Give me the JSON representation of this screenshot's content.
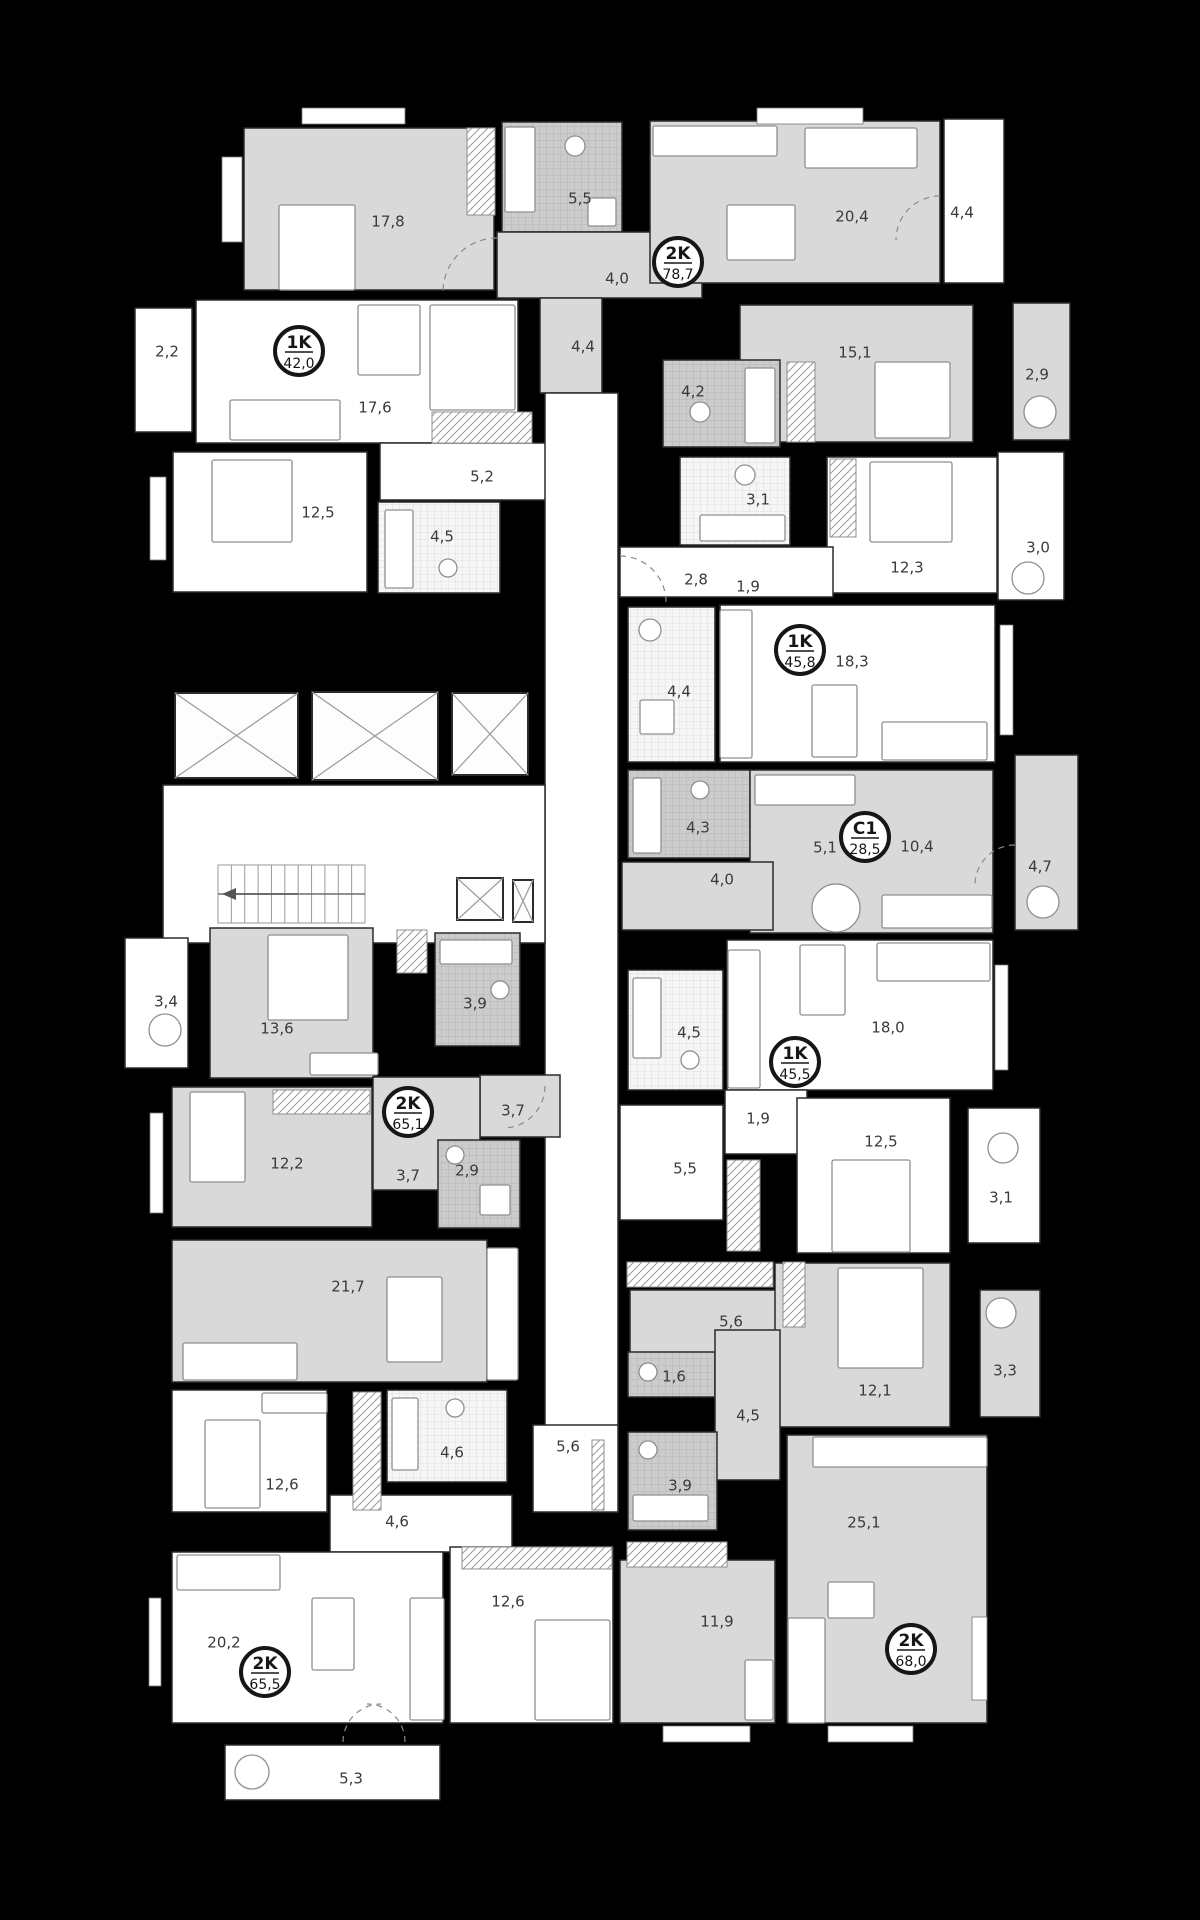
{
  "colors": {
    "background": "#000000",
    "room_gray": "#d9d9d9",
    "room_white": "#ffffff",
    "wall_stroke": "#2b2b2b",
    "furniture_stroke": "#8f8f8f",
    "label_text": "#3a3a3a",
    "badge_ring": "#161616",
    "window_fill": "#ffffff"
  },
  "floorplan": {
    "rooms": [
      {
        "id": "room-17-8",
        "area": "17,8",
        "lx": 388,
        "ly": 222,
        "x": 244,
        "y": 128,
        "w": 250,
        "h": 162,
        "f": "g"
      },
      {
        "id": "bath-5-5",
        "area": "5,5",
        "lx": 580,
        "ly": 199,
        "x": 502,
        "y": 122,
        "w": 120,
        "h": 110,
        "f": "tg"
      },
      {
        "id": "hall-4-0",
        "area": "4,0",
        "lx": 617,
        "ly": 279,
        "x": 497,
        "y": 232,
        "w": 205,
        "h": 66,
        "f": "g"
      },
      {
        "id": "kitchen-20-4",
        "area": "20,4",
        "lx": 852,
        "ly": 217,
        "x": 650,
        "y": 121,
        "w": 290,
        "h": 162,
        "f": "g"
      },
      {
        "id": "balcony-4-4",
        "area": "4,4",
        "lx": 962,
        "ly": 213,
        "x": 944,
        "y": 119,
        "w": 60,
        "h": 164,
        "f": "w"
      },
      {
        "id": "hall-4-4",
        "area": "4,4",
        "lx": 583,
        "ly": 347,
        "x": 540,
        "y": 298,
        "w": 62,
        "h": 95,
        "f": "g"
      },
      {
        "id": "room-15-1",
        "area": "15,1",
        "lx": 855,
        "ly": 353,
        "x": 740,
        "y": 305,
        "w": 233,
        "h": 137,
        "f": "g"
      },
      {
        "id": "balcony-2-9",
        "area": "2,9",
        "lx": 1037,
        "ly": 375,
        "x": 1013,
        "y": 303,
        "w": 57,
        "h": 137,
        "f": "g"
      },
      {
        "id": "bath-4-2",
        "area": "4,2",
        "lx": 693,
        "ly": 392,
        "x": 663,
        "y": 360,
        "w": 117,
        "h": 87,
        "f": "tg"
      },
      {
        "id": "balcony-2-2",
        "area": "2,2",
        "lx": 167,
        "ly": 352,
        "x": 135,
        "y": 308,
        "w": 57,
        "h": 124,
        "f": "w"
      },
      {
        "id": "room-17-6",
        "area": "17,6",
        "lx": 375,
        "ly": 408,
        "x": 196,
        "y": 300,
        "w": 322,
        "h": 143,
        "f": "w"
      },
      {
        "id": "room-12-5",
        "area": "12,5",
        "lx": 318,
        "ly": 513,
        "x": 173,
        "y": 452,
        "w": 194,
        "h": 140,
        "f": "w"
      },
      {
        "id": "hall-5-2",
        "area": "5,2",
        "lx": 482,
        "ly": 477,
        "x": 380,
        "y": 443,
        "w": 168,
        "h": 57,
        "f": "w"
      },
      {
        "id": "bath-4-5",
        "area": "4,5",
        "lx": 442,
        "ly": 537,
        "x": 378,
        "y": 502,
        "w": 122,
        "h": 91,
        "f": "tw"
      },
      {
        "id": "corridor",
        "area": "",
        "lx": 0,
        "ly": 0,
        "x": 545,
        "y": 393,
        "w": 73,
        "h": 1119,
        "f": "w"
      },
      {
        "id": "lobby",
        "area": "",
        "lx": 0,
        "ly": 0,
        "x": 163,
        "y": 785,
        "w": 382,
        "h": 158,
        "f": "w"
      },
      {
        "id": "bath-3-1",
        "area": "3,1",
        "lx": 758,
        "ly": 500,
        "x": 680,
        "y": 457,
        "w": 110,
        "h": 88,
        "f": "tw"
      },
      {
        "id": "room-12-3",
        "area": "12,3",
        "lx": 907,
        "ly": 568,
        "x": 827,
        "y": 457,
        "w": 170,
        "h": 136,
        "f": "w"
      },
      {
        "id": "balcony-3-0",
        "area": "3,0",
        "lx": 1038,
        "ly": 548,
        "x": 998,
        "y": 452,
        "w": 66,
        "h": 148,
        "f": "w"
      },
      {
        "id": "entry-2-8",
        "area": "2,8",
        "lx": 696,
        "ly": 580,
        "x": 620,
        "y": 547,
        "w": 213,
        "h": 50,
        "f": "w"
      },
      {
        "id": "bath-4-4",
        "area": "4,4",
        "lx": 679,
        "ly": 692,
        "x": 628,
        "y": 607,
        "w": 87,
        "h": 155,
        "f": "tw"
      },
      {
        "id": "room-18-3",
        "area": "18,3",
        "lx": 852,
        "ly": 662,
        "x": 720,
        "y": 605,
        "w": 275,
        "h": 157,
        "f": "w"
      },
      {
        "id": "bath-4-3",
        "area": "4,3",
        "lx": 698,
        "ly": 828,
        "x": 628,
        "y": 770,
        "w": 122,
        "h": 88,
        "f": "tg"
      },
      {
        "id": "studio-10-4",
        "area": "10,4",
        "lx": 917,
        "ly": 847,
        "x": 750,
        "y": 770,
        "w": 243,
        "h": 163,
        "f": "g"
      },
      {
        "id": "hall-4-0b",
        "area": "4,0",
        "lx": 722,
        "ly": 880,
        "x": 622,
        "y": 862,
        "w": 151,
        "h": 68,
        "f": "g"
      },
      {
        "id": "balcony-4-7",
        "area": "4,7",
        "lx": 1040,
        "ly": 867,
        "x": 1015,
        "y": 755,
        "w": 63,
        "h": 175,
        "f": "g"
      },
      {
        "id": "bath-4-5b",
        "area": "4,5",
        "lx": 689,
        "ly": 1033,
        "x": 628,
        "y": 970,
        "w": 95,
        "h": 120,
        "f": "tw"
      },
      {
        "id": "room-18-0",
        "area": "18,0",
        "lx": 888,
        "ly": 1028,
        "x": 727,
        "y": 940,
        "w": 266,
        "h": 150,
        "f": "w"
      },
      {
        "id": "closet-1-9",
        "area": "1,9",
        "lx": 758,
        "ly": 1119,
        "x": 725,
        "y": 1090,
        "w": 82,
        "h": 64,
        "f": "w"
      },
      {
        "id": "hall-5-5",
        "area": "5,5",
        "lx": 685,
        "ly": 1169,
        "x": 620,
        "y": 1105,
        "w": 103,
        "h": 115,
        "f": "w"
      },
      {
        "id": "room-12-5b",
        "area": "12,5",
        "lx": 881,
        "ly": 1142,
        "x": 797,
        "y": 1098,
        "w": 153,
        "h": 155,
        "f": "w"
      },
      {
        "id": "balcony-3-1",
        "area": "3,1",
        "lx": 1001,
        "ly": 1198,
        "x": 968,
        "y": 1108,
        "w": 72,
        "h": 135,
        "f": "w"
      },
      {
        "id": "balcony-3-4",
        "area": "3,4",
        "lx": 166,
        "ly": 1002,
        "x": 125,
        "y": 938,
        "w": 63,
        "h": 130,
        "f": "w"
      },
      {
        "id": "room-13-6",
        "area": "13,6",
        "lx": 277,
        "ly": 1029,
        "x": 210,
        "y": 928,
        "w": 163,
        "h": 150,
        "f": "g"
      },
      {
        "id": "bath-3-9",
        "area": "3,9",
        "lx": 475,
        "ly": 1004,
        "x": 435,
        "y": 933,
        "w": 85,
        "h": 113,
        "f": "tg"
      },
      {
        "id": "hall-3-7",
        "area": "3,7",
        "lx": 513,
        "ly": 1111,
        "x": 480,
        "y": 1075,
        "w": 80,
        "h": 62,
        "f": "g"
      },
      {
        "id": "hall-3-7b",
        "area": "3,7",
        "lx": 408,
        "ly": 1176,
        "x": 373,
        "y": 1077,
        "w": 107,
        "h": 113,
        "f": "g"
      },
      {
        "id": "bath-2-9",
        "area": "2,9",
        "lx": 467,
        "ly": 1171,
        "x": 438,
        "y": 1140,
        "w": 82,
        "h": 88,
        "f": "tg"
      },
      {
        "id": "room-12-2",
        "area": "12,2",
        "lx": 287,
        "ly": 1164,
        "x": 172,
        "y": 1087,
        "w": 200,
        "h": 140,
        "f": "g"
      },
      {
        "id": "room-21-7",
        "area": "21,7",
        "lx": 348,
        "ly": 1287,
        "x": 172,
        "y": 1240,
        "w": 315,
        "h": 142,
        "f": "g"
      },
      {
        "id": "room-12-6",
        "area": "12,6",
        "lx": 282,
        "ly": 1485,
        "x": 172,
        "y": 1390,
        "w": 155,
        "h": 122,
        "f": "w"
      },
      {
        "id": "bath-4-6",
        "area": "4,6",
        "lx": 452,
        "ly": 1453,
        "x": 387,
        "y": 1390,
        "w": 120,
        "h": 92,
        "f": "tw"
      },
      {
        "id": "corridor-5-6",
        "area": "5,6",
        "lx": 568,
        "ly": 1447,
        "x": 533,
        "y": 1425,
        "w": 85,
        "h": 87,
        "f": "w"
      },
      {
        "id": "hall-4-6",
        "area": "4,6",
        "lx": 397,
        "ly": 1522,
        "x": 330,
        "y": 1495,
        "w": 182,
        "h": 57,
        "f": "w"
      },
      {
        "id": "room-20-2",
        "area": "20,2",
        "lx": 224,
        "ly": 1643,
        "x": 172,
        "y": 1552,
        "w": 271,
        "h": 171,
        "f": "w"
      },
      {
        "id": "room-12-6b",
        "area": "12,6",
        "lx": 508,
        "ly": 1602,
        "x": 450,
        "y": 1547,
        "w": 163,
        "h": 176,
        "f": "w"
      },
      {
        "id": "balcony-5-3",
        "area": "5,3",
        "lx": 351,
        "ly": 1779,
        "x": 225,
        "y": 1745,
        "w": 215,
        "h": 55,
        "f": "w"
      },
      {
        "id": "hall-5-6",
        "area": "5,6",
        "lx": 731,
        "ly": 1322,
        "x": 630,
        "y": 1290,
        "w": 147,
        "h": 80,
        "f": "g"
      },
      {
        "id": "room-12-1",
        "area": "12,1",
        "lx": 875,
        "ly": 1391,
        "x": 775,
        "y": 1263,
        "w": 175,
        "h": 164,
        "f": "g"
      },
      {
        "id": "balcony-3-3",
        "area": "3,3",
        "lx": 1005,
        "ly": 1371,
        "x": 980,
        "y": 1290,
        "w": 60,
        "h": 127,
        "f": "g"
      },
      {
        "id": "wc-1-6",
        "area": "1,6",
        "lx": 674,
        "ly": 1377,
        "x": 628,
        "y": 1352,
        "w": 87,
        "h": 45,
        "f": "tg"
      },
      {
        "id": "hall-4-5",
        "area": "4,5",
        "lx": 748,
        "ly": 1416,
        "x": 715,
        "y": 1330,
        "w": 65,
        "h": 150,
        "f": "g"
      },
      {
        "id": "bath-3-9b",
        "area": "3,9",
        "lx": 680,
        "ly": 1486,
        "x": 628,
        "y": 1432,
        "w": 89,
        "h": 98,
        "f": "tg"
      },
      {
        "id": "room-25-1",
        "area": "25,1",
        "lx": 864,
        "ly": 1523,
        "x": 787,
        "y": 1435,
        "w": 200,
        "h": 288,
        "f": "g"
      },
      {
        "id": "room-11-9",
        "area": "11,9",
        "lx": 717,
        "ly": 1622,
        "x": 620,
        "y": 1560,
        "w": 155,
        "h": 163,
        "f": "g"
      }
    ],
    "extra_labels": [
      {
        "t": "1,9",
        "x": 748,
        "y": 587
      },
      {
        "t": "5,1",
        "x": 825,
        "y": 848
      }
    ],
    "badges": [
      {
        "type": "2K",
        "area": "78,7",
        "x": 678,
        "y": 262
      },
      {
        "type": "1K",
        "area": "42,0",
        "x": 299,
        "y": 351
      },
      {
        "type": "1K",
        "area": "45,8",
        "x": 800,
        "y": 650
      },
      {
        "type": "C1",
        "area": "28,5",
        "x": 865,
        "y": 837
      },
      {
        "type": "1K",
        "area": "45,5",
        "x": 795,
        "y": 1062
      },
      {
        "type": "2K",
        "area": "65,1",
        "x": 408,
        "y": 1112
      },
      {
        "type": "2K",
        "area": "65,5",
        "x": 265,
        "y": 1672
      },
      {
        "type": "2K",
        "area": "68,0",
        "x": 911,
        "y": 1649
      }
    ],
    "hatches": [
      [
        467,
        128,
        28,
        87
      ],
      [
        432,
        412,
        100,
        31
      ],
      [
        787,
        362,
        28,
        80
      ],
      [
        830,
        459,
        26,
        78
      ],
      [
        273,
        1090,
        97,
        24
      ],
      [
        727,
        1160,
        33,
        91
      ],
      [
        353,
        1392,
        28,
        118
      ],
      [
        627,
        1262,
        146,
        25
      ],
      [
        627,
        1542,
        100,
        25
      ],
      [
        462,
        1547,
        150,
        22
      ],
      [
        783,
        1262,
        22,
        65
      ],
      [
        397,
        930,
        30,
        43
      ],
      [
        592,
        1440,
        12,
        70
      ]
    ],
    "windows": [
      [
        222,
        157,
        20,
        85
      ],
      [
        302,
        108,
        103,
        16
      ],
      [
        757,
        108,
        106,
        16
      ],
      [
        150,
        477,
        16,
        83
      ],
      [
        1000,
        625,
        13,
        110
      ],
      [
        995,
        965,
        13,
        105
      ],
      [
        150,
        1113,
        13,
        100
      ],
      [
        149,
        1598,
        12,
        88
      ],
      [
        972,
        1617,
        15,
        83
      ],
      [
        663,
        1726,
        87,
        16
      ],
      [
        828,
        1726,
        85,
        16
      ]
    ],
    "shafts": [
      [
        175,
        693,
        123,
        85
      ],
      [
        312,
        692,
        126,
        88
      ],
      [
        452,
        693,
        76,
        82
      ],
      [
        457,
        878,
        46,
        42
      ],
      [
        513,
        880,
        20,
        42
      ]
    ],
    "stairs": {
      "x": 218,
      "y": 865,
      "w": 147,
      "h": 58,
      "steps": 11
    },
    "furniture_rects": [
      [
        279,
        205,
        76,
        85
      ],
      [
        875,
        362,
        75,
        76
      ],
      [
        212,
        460,
        80,
        82
      ],
      [
        870,
        462,
        82,
        80
      ],
      [
        832,
        1160,
        78,
        92
      ],
      [
        268,
        935,
        80,
        85
      ],
      [
        190,
        1092,
        55,
        90
      ],
      [
        838,
        1268,
        85,
        100
      ],
      [
        535,
        1620,
        75,
        100
      ],
      [
        205,
        1420,
        55,
        88
      ],
      [
        727,
        205,
        68,
        55
      ],
      [
        358,
        305,
        62,
        70
      ],
      [
        812,
        685,
        45,
        72
      ],
      [
        800,
        945,
        45,
        70
      ],
      [
        387,
        1277,
        55,
        85
      ],
      [
        312,
        1598,
        42,
        72
      ],
      [
        828,
        1582,
        46,
        36
      ],
      [
        805,
        128,
        112,
        40
      ],
      [
        882,
        722,
        105,
        38
      ],
      [
        877,
        943,
        113,
        38
      ],
      [
        882,
        895,
        110,
        33
      ],
      [
        183,
        1343,
        114,
        37
      ],
      [
        177,
        1555,
        103,
        35
      ],
      [
        788,
        1618,
        37,
        105
      ],
      [
        230,
        400,
        110,
        40
      ],
      [
        745,
        1660,
        28,
        60
      ],
      [
        310,
        1053,
        68,
        22
      ],
      [
        262,
        1393,
        65,
        20
      ],
      [
        653,
        126,
        124,
        30
      ],
      [
        430,
        305,
        85,
        105
      ],
      [
        720,
        610,
        32,
        148
      ],
      [
        728,
        950,
        32,
        138
      ],
      [
        755,
        775,
        100,
        30
      ],
      [
        487,
        1248,
        31,
        132
      ],
      [
        813,
        1437,
        174,
        30
      ],
      [
        410,
        1598,
        34,
        122
      ],
      [
        505,
        127,
        30,
        85
      ],
      [
        745,
        368,
        30,
        75
      ],
      [
        700,
        515,
        85,
        26
      ],
      [
        385,
        510,
        28,
        78
      ],
      [
        633,
        778,
        28,
        75
      ],
      [
        633,
        978,
        28,
        80
      ],
      [
        440,
        940,
        72,
        24
      ],
      [
        633,
        1495,
        75,
        26
      ],
      [
        392,
        1398,
        26,
        72
      ],
      [
        640,
        700,
        34,
        34
      ],
      [
        480,
        1185,
        30,
        30
      ],
      [
        588,
        198,
        28,
        28
      ]
    ],
    "furniture_circles": [
      [
        165,
        1030,
        16
      ],
      [
        1040,
        412,
        16
      ],
      [
        1028,
        578,
        16
      ],
      [
        1003,
        1148,
        15
      ],
      [
        1001,
        1313,
        15
      ],
      [
        1043,
        902,
        16
      ],
      [
        252,
        1772,
        17
      ],
      [
        836,
        908,
        24
      ],
      [
        575,
        146,
        10
      ],
      [
        700,
        412,
        10
      ],
      [
        745,
        475,
        10
      ],
      [
        448,
        568,
        9
      ],
      [
        650,
        630,
        11
      ],
      [
        700,
        790,
        9
      ],
      [
        690,
        1060,
        9
      ],
      [
        500,
        990,
        9
      ],
      [
        455,
        1155,
        9
      ],
      [
        648,
        1372,
        9
      ],
      [
        648,
        1450,
        9
      ],
      [
        455,
        1408,
        9
      ]
    ],
    "door_arcs": [
      "M497,238 A54,54 0 0 0 443,292",
      "M940,196 A44,44 0 0 0 896,240",
      "M620,556 A46,46 0 0 1 666,602",
      "M545,1086 A42,42 0 0 1 503,1128",
      "M343,1742 A38,38 0 0 1 381,1704",
      "M405,1742 A38,38 0 0 0 367,1704",
      "M1015,845 A40,40 0 0 0 975,885"
    ]
  }
}
